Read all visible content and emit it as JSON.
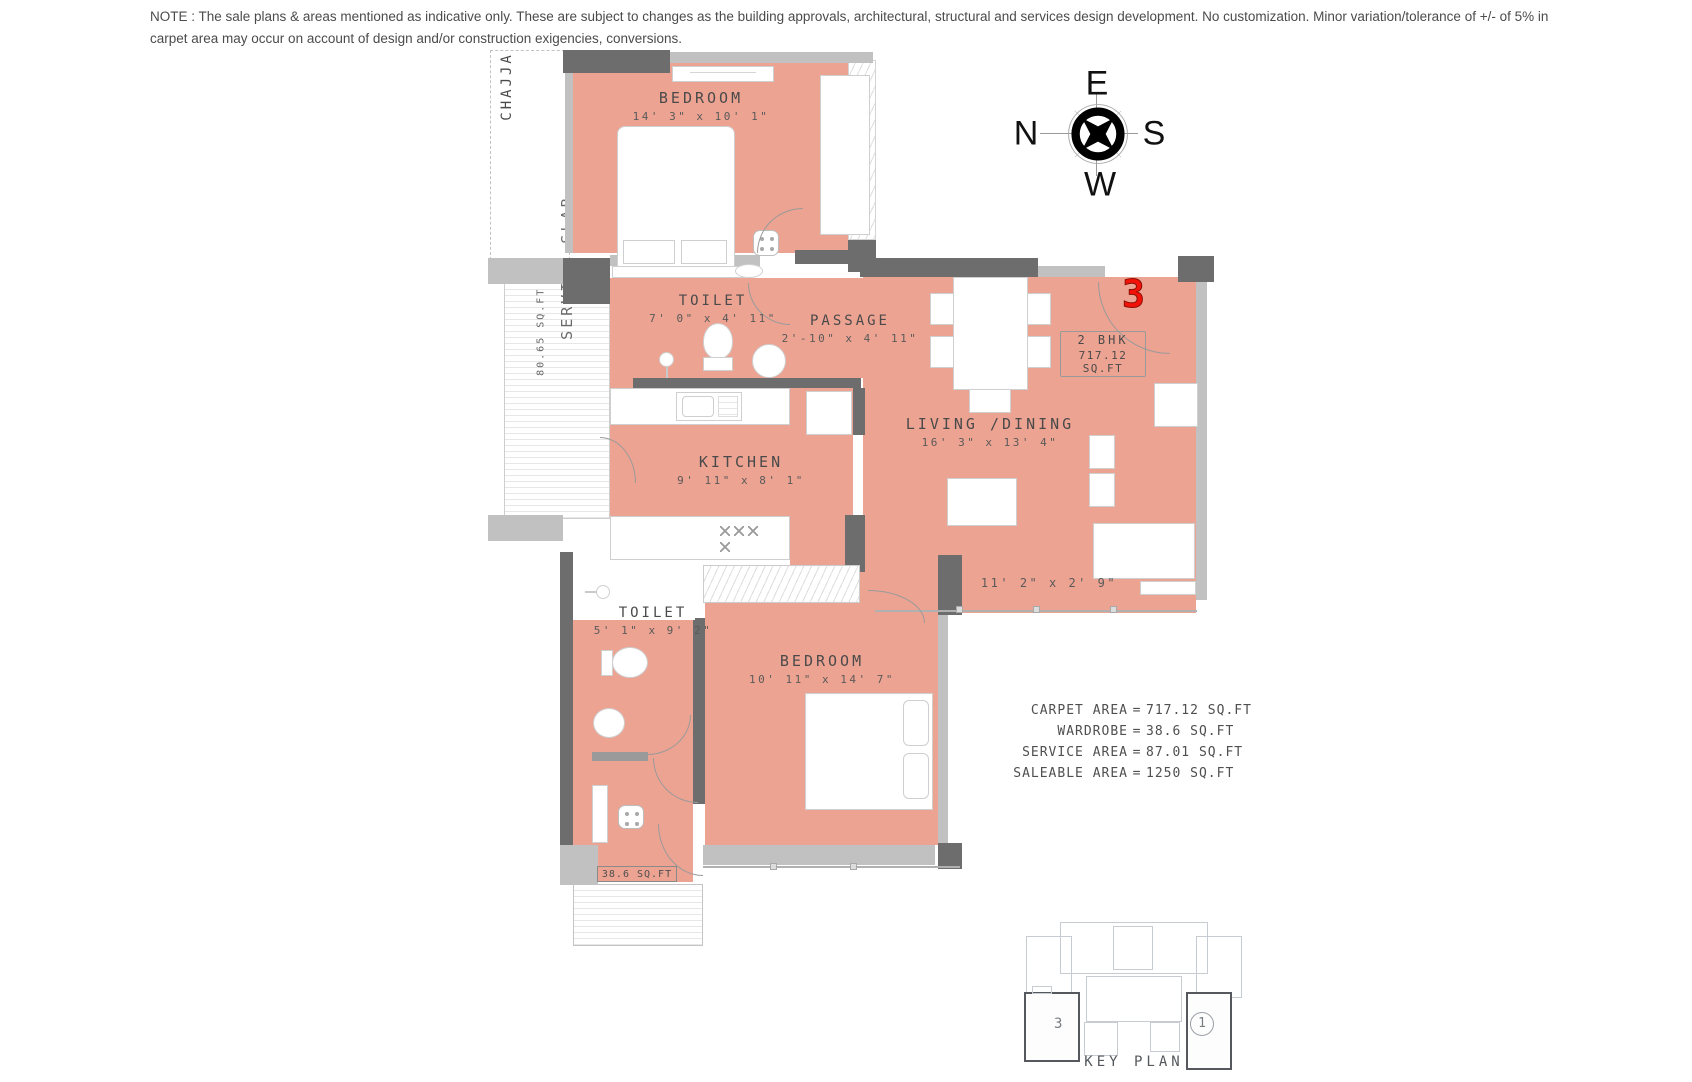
{
  "note": {
    "text": "NOTE : The sale plans & areas mentioned as indicative only. These are subject to changes as the building approvals, architectural, structural and services design development. No customization. Minor variation/tolerance of +/- of 5% in carpet area may occur on account of design and/or construction exigencies, conversions."
  },
  "compass": {
    "top": "E",
    "left": "N",
    "right": "S",
    "bottom": "W"
  },
  "unit": {
    "number": "3",
    "type": "2 BHK",
    "area": "717.12 SQ.FT"
  },
  "rooms": {
    "bedroom1": {
      "name": "BEDROOM",
      "dims": "14' 3\" x 10' 1\""
    },
    "toilet1": {
      "name": "TOILET",
      "dims": "7' 0\" x 4' 11\""
    },
    "passage": {
      "name": "PASSAGE",
      "dims": "2'-10\" x 4' 11\""
    },
    "kitchen": {
      "name": "KITCHEN",
      "dims": "9' 11\" x 8' 1\""
    },
    "living": {
      "name": "LIVING /DINING",
      "dims": "16' 3\" x 13' 4\""
    },
    "toilet2": {
      "name": "TOILET",
      "dims": "5' 1\" x 9' 2\""
    },
    "bedroom2": {
      "name": "BEDROOM",
      "dims": "10' 11\" x 14' 7\""
    },
    "balcony_dims": "11' 2\" x 2' 9\"",
    "chajja": "CHAJJA",
    "service_slab": {
      "name": "SERVICE SLAB",
      "area": "80.65 SQ.FT"
    },
    "wardrobe_area": "38.6 SQ.FT"
  },
  "areas": {
    "eq": "=",
    "rows": [
      {
        "label": "CARPET AREA",
        "value": "717.12 SQ.FT"
      },
      {
        "label": "WARDROBE",
        "value": "38.6 SQ.FT"
      },
      {
        "label": "SERVICE AREA",
        "value": "87.01 SQ.FT"
      },
      {
        "label": "SALEABLE AREA",
        "value": "1250 SQ.FT"
      }
    ]
  },
  "key_plan": {
    "title": "KEY PLAN",
    "unit_left": "3",
    "unit_right": "1"
  },
  "colors": {
    "room_fill": "#eca392",
    "wall_dark": "#6d6d6d",
    "wall_light": "#c1c1c1",
    "unit_red": "#f31208"
  }
}
